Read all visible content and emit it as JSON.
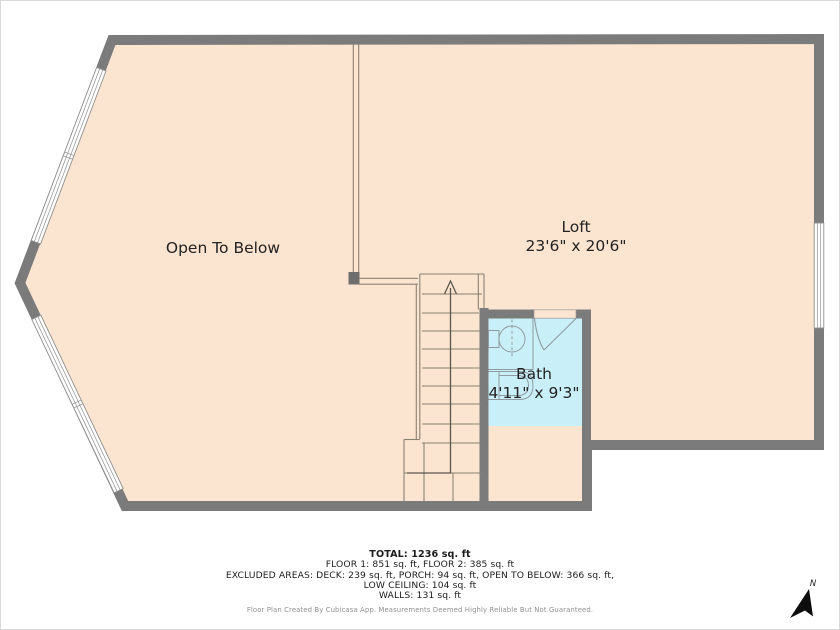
{
  "plan": {
    "rooms": {
      "open_to_below": {
        "label": "Open To Below"
      },
      "loft": {
        "label": "Loft",
        "dimensions": "23'6\" x 20'6\""
      },
      "bath": {
        "label": "Bath",
        "dimensions": "4'11\" x 9'3\""
      }
    },
    "compass": {
      "label": "N"
    }
  },
  "summary": {
    "total": "TOTAL: 1236 sq. ft",
    "floors": "FLOOR 1: 851 sq. ft, FLOOR 2: 385 sq. ft",
    "excluded_areas": "EXCLUDED AREAS: DECK: 239 sq. ft, PORCH: 94 sq. ft, OPEN TO BELOW: 366 sq. ft,",
    "low_ceiling": "LOW CEILING: 104 sq. ft",
    "walls": "WALLS: 131 sq. ft",
    "credit": "Floor Plan Created By Cubicasa App. Measurements Deemed Highly Reliable But Not Guaranteed."
  },
  "colors": {
    "floor": "#fbe5d0",
    "bath_floor": "#c9f0f8",
    "wall": "#7b7b7b",
    "accent_line": "#8a8175"
  }
}
